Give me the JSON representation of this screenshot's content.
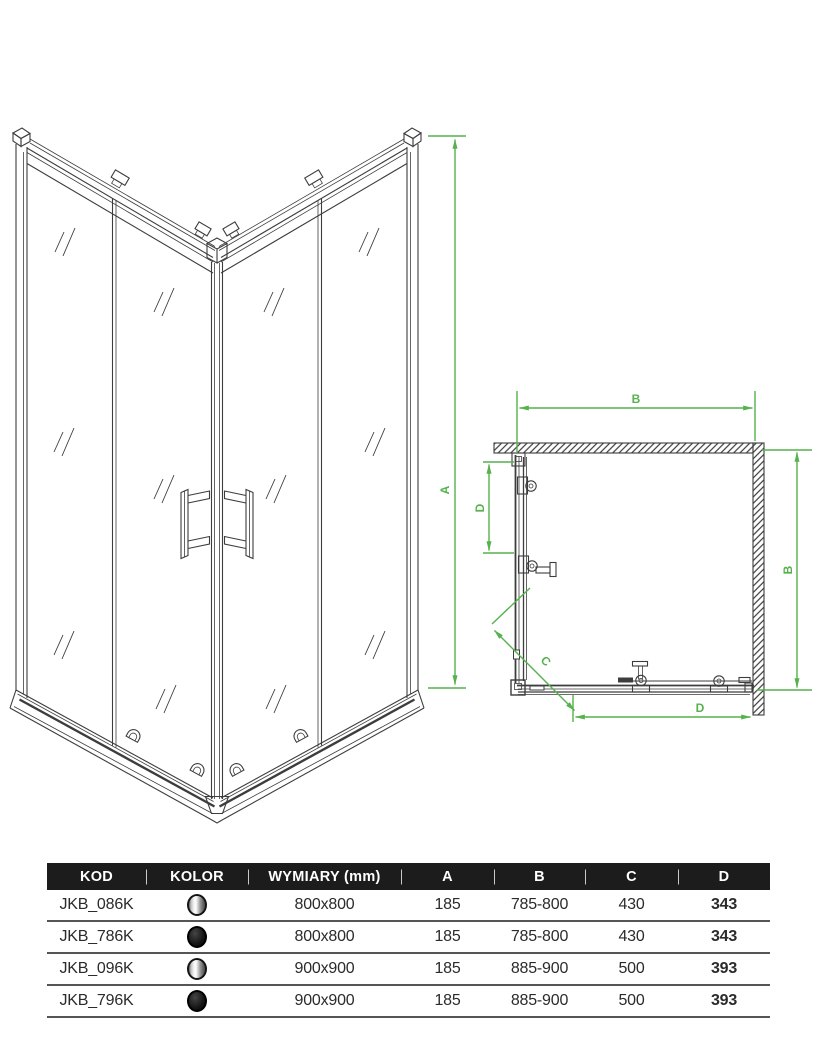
{
  "colors": {
    "dimension_green": "#55b24d",
    "drawing_line": "#3d3d3d",
    "header_bg": "#1c1c1c"
  },
  "iso_view": {
    "dim_a": "A"
  },
  "top_view": {
    "dim_b_top": "B",
    "dim_b_right": "B",
    "dim_d_left": "D",
    "dim_d_bottom": "D",
    "dim_c": "C"
  },
  "table": {
    "headers": [
      "KOD",
      "KOLOR",
      "WYMIARY (mm)",
      "A",
      "B",
      "C",
      "D"
    ],
    "rows": [
      {
        "kod": "JKB_086K",
        "kolor": "chrome",
        "wymiary": "800x800",
        "a": "185",
        "b": "785-800",
        "c": "430",
        "d": "343"
      },
      {
        "kod": "JKB_786K",
        "kolor": "black",
        "wymiary": "800x800",
        "a": "185",
        "b": "785-800",
        "c": "430",
        "d": "343"
      },
      {
        "kod": "JKB_096K",
        "kolor": "chrome",
        "wymiary": "900x900",
        "a": "185",
        "b": "885-900",
        "c": "500",
        "d": "393"
      },
      {
        "kod": "JKB_796K",
        "kolor": "black",
        "wymiary": "900x900",
        "a": "185",
        "b": "885-900",
        "c": "500",
        "d": "393"
      }
    ]
  }
}
